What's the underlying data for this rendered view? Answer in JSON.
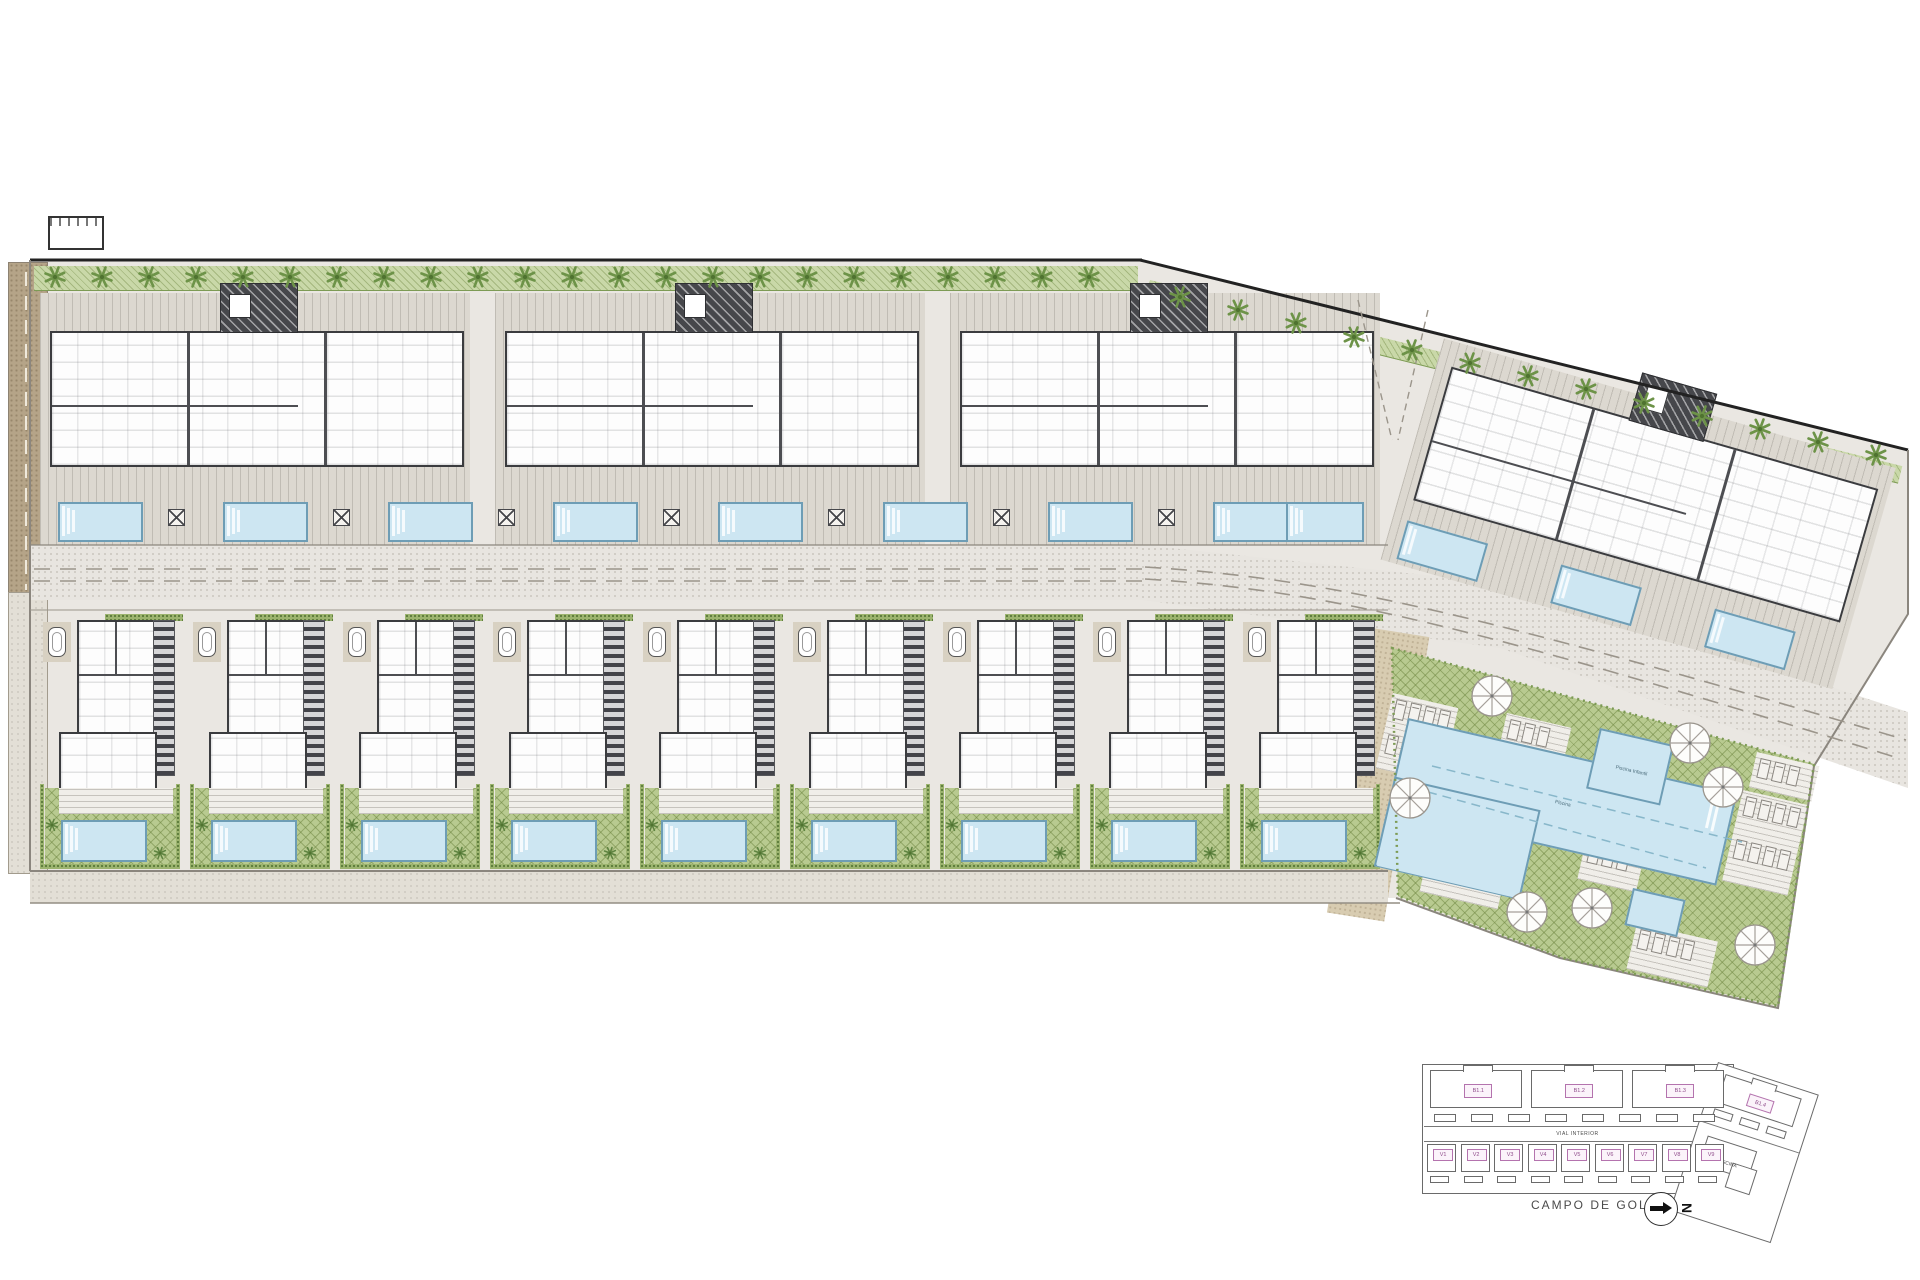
{
  "amenity": {
    "main_pool_label": "Piscina",
    "kids_pool_label": "Piscina Infantil"
  },
  "key_plan": {
    "building_labels": [
      "B1.1",
      "B1.2",
      "B1.3"
    ],
    "building4_label": "B1.4",
    "villa_labels": [
      "V1",
      "V2",
      "V3",
      "V4",
      "V5",
      "V6",
      "V7",
      "V8",
      "V9"
    ],
    "road_label": "VIAL INTERIOR",
    "golf_label": "CAMPO DE GOLF",
    "pool_area_label": "PISCINA",
    "north_letter": "N"
  },
  "colors": {
    "paving": "#eae7e2",
    "terrace_stripe": "#dcd8d0",
    "garden_green": "#b8ca90",
    "pool_fill": "#cde6f2",
    "pool_border": "#6e9db5",
    "wall_dark": "#3b3c3f",
    "tree_green": "#6d9348",
    "road_dash": "#9b958b",
    "path_brown": "#b5a488",
    "label_pink": "#8e4a8a"
  }
}
